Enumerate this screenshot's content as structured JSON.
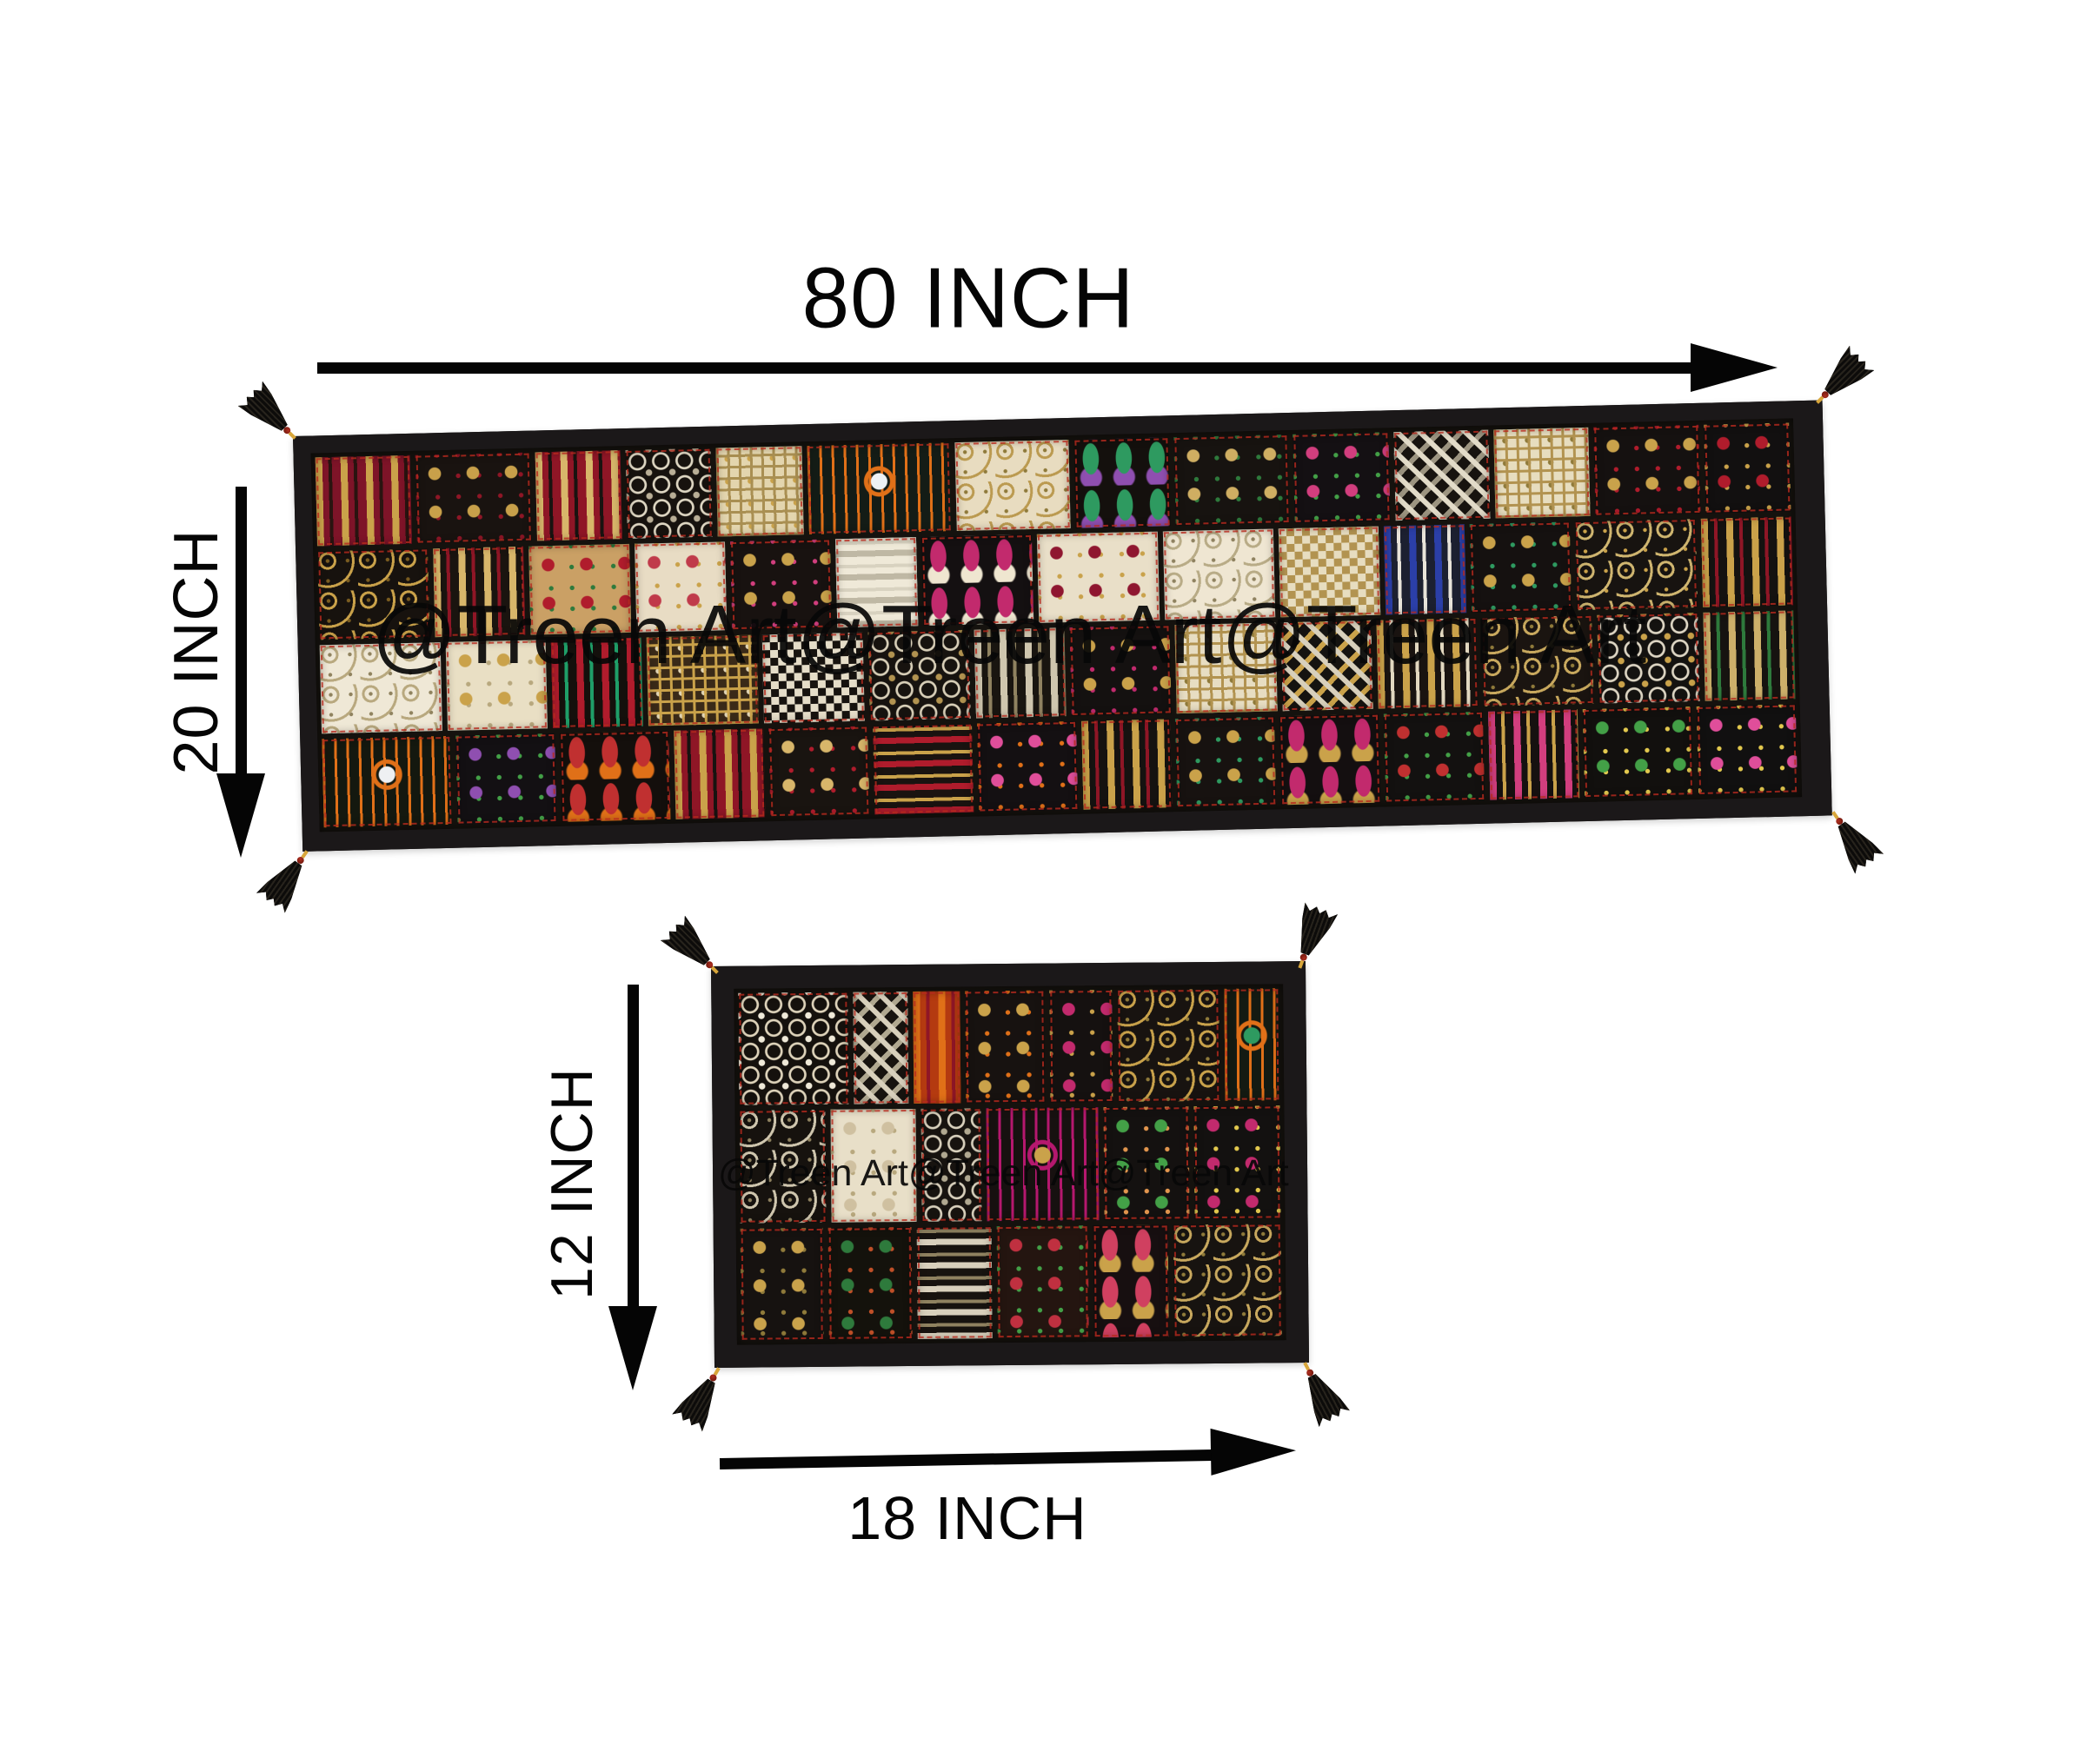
{
  "labels": {
    "runner_width": "80 INCH",
    "runner_height": "20 INCH",
    "mat_height": "12 INCH",
    "mat_width": "18 INCH"
  },
  "watermarks": {
    "runner": "@Treen Art@Treen Art@Treen Art",
    "mat": "@Treen Art@Treen Art@Treen Art"
  },
  "colors": {
    "background": "#ffffff",
    "annotation": "#050505",
    "binding": "#1b1819",
    "fabric_base": "#15120e",
    "stitch": "#b92a1e",
    "tassel": "#16140f",
    "bead_gold": "#d8a63a",
    "bead_red": "#b03020"
  },
  "runner": {
    "rows": [
      [
        {
          "p": "stripes",
          "a": "#7e1428",
          "b": "#caa24a",
          "c": "#2a1410",
          "w": 1
        },
        {
          "p": "floral",
          "a": "#191310",
          "b": "#c8a04a",
          "c": "#8f1626",
          "w": 1.2
        },
        {
          "p": "stripes",
          "a": "#8f1626",
          "b": "#d8b66a",
          "c": "#191310",
          "w": 0.9
        },
        {
          "p": "lace",
          "a": "#17120e",
          "b": "#ded6c2",
          "c": "#b9ae96",
          "w": 0.9
        },
        {
          "p": "grid",
          "a": "#e3d5ae",
          "b": "#a98f52",
          "c": "#c9a24b",
          "w": 0.9
        },
        {
          "p": "medallion",
          "a": "#141c16",
          "b": "#e07018",
          "c": "#eef2f4",
          "w": 1.5
        },
        {
          "p": "scroll",
          "a": "#e8dcc0",
          "b": "#bb9a50",
          "c": "#8f7a3a",
          "w": 1.2
        },
        {
          "p": "paisley",
          "a": "#14100d",
          "b": "#2e9a60",
          "c": "#8f4fb0",
          "w": 1
        },
        {
          "p": "floral",
          "a": "#171310",
          "b": "#cfae62",
          "c": "#2e7a3c",
          "w": 1.2
        },
        {
          "p": "floral",
          "a": "#141013",
          "b": "#d23e7e",
          "c": "#43a047",
          "w": 1
        },
        {
          "p": "zigzag",
          "a": "#17130f",
          "b": "#e2dbc8",
          "c": "#9c9480",
          "w": 1
        },
        {
          "p": "grid",
          "a": "#e7ddbf",
          "b": "#b29350",
          "c": "#8f7a3a",
          "w": 1
        },
        {
          "p": "floral",
          "a": "#151110",
          "b": "#c9a24b",
          "c": "#b01c2c",
          "w": 1.1
        },
        {
          "p": "floral",
          "a": "#121010",
          "b": "#b01c2c",
          "c": "#caa24a",
          "w": 0.9
        }
      ],
      [
        {
          "p": "scroll",
          "a": "#17120e",
          "b": "#caa24a",
          "c": "#7a5c20",
          "w": 1.1
        },
        {
          "p": "stripes",
          "a": "#1a140f",
          "b": "#d8b66a",
          "c": "#8f1626",
          "w": 0.9
        },
        {
          "p": "floral",
          "a": "#caa065",
          "b": "#b01c2c",
          "c": "#2e7a3c",
          "w": 1
        },
        {
          "p": "floral",
          "a": "#e8dcc4",
          "b": "#c03a4a",
          "c": "#caa24a",
          "w": 0.9
        },
        {
          "p": "floral",
          "a": "#181210",
          "b": "#c9a24b",
          "c": "#d23e7e",
          "w": 1
        },
        {
          "p": "hstripes",
          "a": "#efe9d8",
          "b": "#bfb8a4",
          "c": "#d8d2c0",
          "w": 0.8
        },
        {
          "p": "paisley",
          "a": "#141011",
          "b": "#c22a6d",
          "c": "#efe6d0",
          "w": 1.1
        },
        {
          "p": "floral",
          "a": "#e9dfc8",
          "b": "#8f1630",
          "c": "#c9a24b",
          "w": 1.2
        },
        {
          "p": "scroll",
          "a": "#efe6d2",
          "b": "#b8ab86",
          "c": "#8f8260",
          "w": 1.1
        },
        {
          "p": "check",
          "a": "#e7ddc0",
          "b": "#b29350",
          "c": "#caa24a",
          "w": 1
        },
        {
          "p": "stripes",
          "a": "#1c2030",
          "b": "#2b3fa8",
          "c": "#e8e4da",
          "w": 0.8
        },
        {
          "p": "floral",
          "a": "#151110",
          "b": "#caa24a",
          "c": "#2e9a60",
          "w": 1
        },
        {
          "p": "scroll",
          "a": "#171310",
          "b": "#d0b670",
          "c": "#caa24a",
          "w": 1.2
        },
        {
          "p": "stripes",
          "a": "#141210",
          "b": "#caa24a",
          "c": "#8f1626",
          "w": 0.9
        }
      ],
      [
        {
          "p": "scroll",
          "a": "#efe8d6",
          "b": "#b8a87e",
          "c": "#90835f",
          "w": 1.2
        },
        {
          "p": "floral",
          "a": "#e9dfc4",
          "b": "#caa24a",
          "c": "#b8a87e",
          "w": 1
        },
        {
          "p": "stripes",
          "a": "#14100c",
          "b": "#b01c2c",
          "c": "#1f9e68",
          "w": 0.9
        },
        {
          "p": "grid",
          "a": "#3a2a18",
          "b": "#caa24a",
          "c": "#e0d4b4",
          "w": 1.1
        },
        {
          "p": "check",
          "a": "#17130f",
          "b": "#e5ddc8",
          "c": "#caa24a",
          "w": 1
        },
        {
          "p": "lace",
          "a": "#17130f",
          "b": "#d8cfb8",
          "c": "#b29350",
          "w": 1
        },
        {
          "p": "stripes",
          "a": "#191510",
          "b": "#cfc6ae",
          "c": "#8f8260",
          "w": 0.9
        },
        {
          "p": "floral",
          "a": "#141110",
          "b": "#caa24a",
          "c": "#c22a6d",
          "w": 1
        },
        {
          "p": "grid",
          "a": "#e7ddc2",
          "b": "#b29350",
          "c": "#8f7a3a",
          "w": 1
        },
        {
          "p": "zigzag",
          "a": "#151310",
          "b": "#d8d0bc",
          "c": "#caa24a",
          "w": 0.9
        },
        {
          "p": "stripes",
          "a": "#191310",
          "b": "#caa24a",
          "c": "#e2d8c0",
          "w": 1
        },
        {
          "p": "scroll",
          "a": "#1a1410",
          "b": "#c9a95e",
          "c": "#8f7a3a",
          "w": 1.1
        },
        {
          "p": "lace",
          "a": "#141210",
          "b": "#ded6c4",
          "c": "#caa24a",
          "w": 1
        },
        {
          "p": "stripes",
          "a": "#161310",
          "b": "#cdb06a",
          "c": "#2e7a3c",
          "w": 0.9
        }
      ],
      [
        {
          "p": "medallion",
          "a": "#14180f",
          "b": "#e07018",
          "c": "#eef0f2",
          "w": 1.3
        },
        {
          "p": "floral",
          "a": "#131013",
          "b": "#8f4fb0",
          "c": "#43a047",
          "w": 1
        },
        {
          "p": "paisley",
          "a": "#140f0c",
          "b": "#c03030",
          "c": "#e07018",
          "w": 1.1
        },
        {
          "p": "stripes",
          "a": "#8f1626",
          "b": "#caa24a",
          "c": "#171310",
          "w": 0.9
        },
        {
          "p": "floral",
          "a": "#191410",
          "b": "#d8b66a",
          "c": "#b01c2c",
          "w": 1
        },
        {
          "p": "hstripes",
          "a": "#1a1310",
          "b": "#b01c2c",
          "c": "#caa24a",
          "w": 1
        },
        {
          "p": "floral",
          "a": "#141012",
          "b": "#e04e9a",
          "c": "#e07018",
          "w": 1
        },
        {
          "p": "stripes",
          "a": "#151210",
          "b": "#caa24a",
          "c": "#8f1626",
          "w": 0.9
        },
        {
          "p": "floral",
          "a": "#171210",
          "b": "#caa24a",
          "c": "#2e9a60",
          "w": 1
        },
        {
          "p": "paisley",
          "a": "#140f10",
          "b": "#c22a6d",
          "c": "#caa24a",
          "w": 1
        },
        {
          "p": "floral",
          "a": "#131110",
          "b": "#c03030",
          "c": "#43a047",
          "w": 1
        },
        {
          "p": "stripes",
          "a": "#161110",
          "b": "#d23e7e",
          "c": "#caa24a",
          "w": 0.9
        },
        {
          "p": "floral",
          "a": "#12100e",
          "b": "#43a047",
          "c": "#e3c94e",
          "w": 1.1
        },
        {
          "p": "floral",
          "a": "#111010",
          "b": "#e04e9a",
          "c": "#e3c94e",
          "w": 1
        }
      ]
    ]
  },
  "mat": {
    "rows": [
      [
        {
          "p": "lace",
          "a": "#15110d",
          "b": "#ded3ba",
          "c": "#efe9d8",
          "w": 1.4
        },
        {
          "p": "zigzag",
          "a": "#17130f",
          "b": "#d8d0bc",
          "c": "#b0a890",
          "w": 0.7
        },
        {
          "p": "stripes",
          "a": "#b43a10",
          "b": "#e07018",
          "c": "#8f1626",
          "w": 0.6
        },
        {
          "p": "floral",
          "a": "#171210",
          "b": "#caa24a",
          "c": "#e07018",
          "w": 1
        },
        {
          "p": "floral",
          "a": "#151110",
          "b": "#c22a6d",
          "c": "#caa24a",
          "w": 0.8
        },
        {
          "p": "scroll",
          "a": "#181310",
          "b": "#c9a24b",
          "c": "#8f7a3a",
          "w": 1.3
        },
        {
          "p": "medallion",
          "a": "#141a12",
          "b": "#e07018",
          "c": "#2e9a60",
          "w": 0.7
        }
      ],
      [
        {
          "p": "scroll",
          "a": "#16120e",
          "b": "#cfc6ae",
          "c": "#8f8260",
          "w": 1
        },
        {
          "p": "floral",
          "a": "#e8dfc8",
          "b": "#cfc0a0",
          "c": "#b8a87e",
          "w": 1
        },
        {
          "p": "lace",
          "a": "#17130f",
          "b": "#d8d0bc",
          "c": "#b0a890",
          "w": 0.7
        },
        {
          "p": "medallion",
          "a": "#171110",
          "b": "#b5186e",
          "c": "#caa24a",
          "w": 1.3
        },
        {
          "p": "floral",
          "a": "#141110",
          "b": "#43a047",
          "c": "#e3964e",
          "w": 1
        },
        {
          "p": "floral",
          "a": "#131110",
          "b": "#c22a6d",
          "c": "#e3c94e",
          "w": 1
        }
      ],
      [
        {
          "p": "floral",
          "a": "#161210",
          "b": "#c9a24b",
          "c": "#8f7a3a",
          "w": 1
        },
        {
          "p": "floral",
          "a": "#14120c",
          "b": "#2e7a3c",
          "c": "#c05028",
          "w": 1
        },
        {
          "p": "hstripes",
          "a": "#17130f",
          "b": "#d8d0bc",
          "c": "#8f8260",
          "w": 0.9
        },
        {
          "p": "floral",
          "a": "#241510",
          "b": "#c03040",
          "c": "#43a047",
          "w": 1.1
        },
        {
          "p": "paisley",
          "a": "#170f10",
          "b": "#d04060",
          "c": "#caa24a",
          "w": 0.9
        },
        {
          "p": "scroll",
          "a": "#171310",
          "b": "#c9a95e",
          "c": "#8f7a3a",
          "w": 1.3
        }
      ]
    ]
  }
}
